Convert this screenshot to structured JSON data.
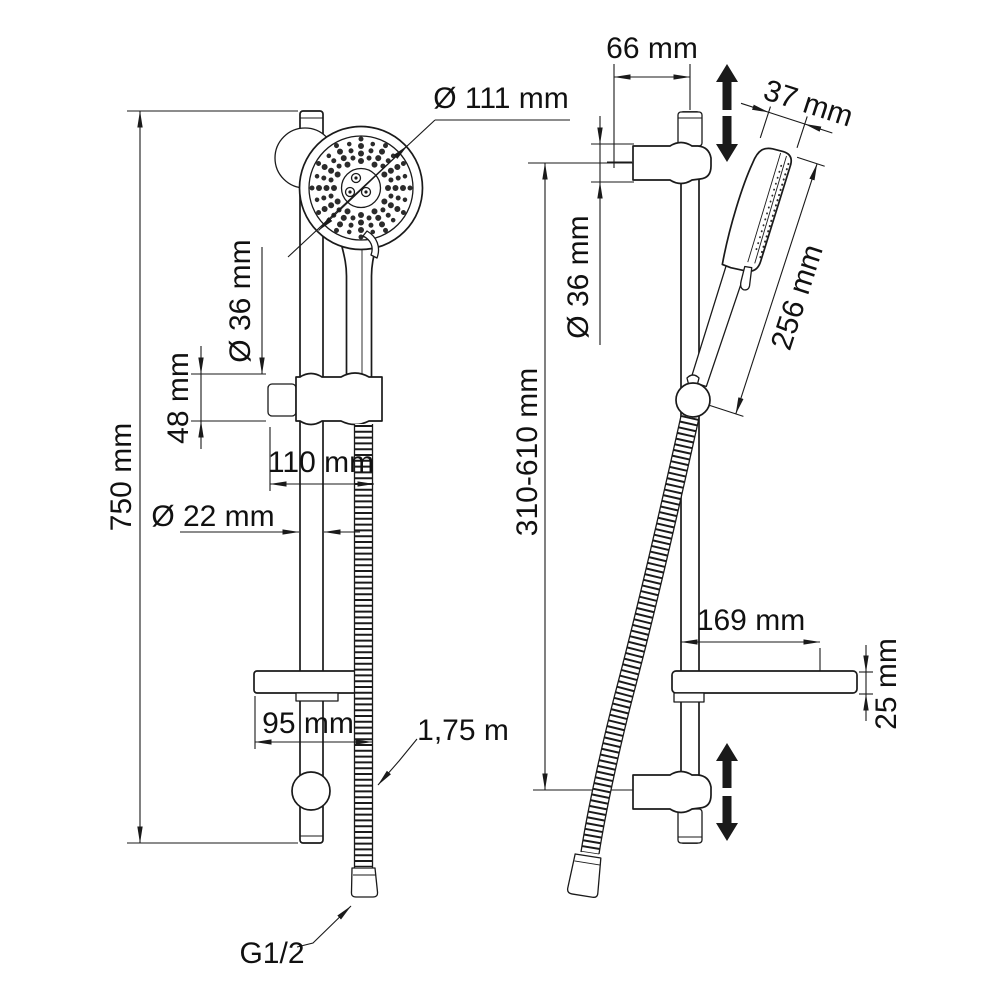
{
  "drawing": {
    "left_view": {
      "head_diameter": "Ø 111 mm",
      "rail_length": "750 mm",
      "holder_diameter": "Ø 36 mm",
      "holder_height": "48 mm",
      "holder_offset": "110 mm",
      "rail_diameter": "Ø 22 mm",
      "shelf_width": "95 mm",
      "hose_length": "1,75 m",
      "connection_thread": "G1/2"
    },
    "right_view": {
      "wall_offset": "66 mm",
      "head_thickness": "37 mm",
      "head_length": "256 mm",
      "height_range": "310-610 mm",
      "bracket_diameter": "Ø 36 mm",
      "shelf_depth": "169 mm",
      "shelf_thickness": "25 mm"
    },
    "colors": {
      "line": "#1a1a1a",
      "background": "#ffffff"
    }
  }
}
